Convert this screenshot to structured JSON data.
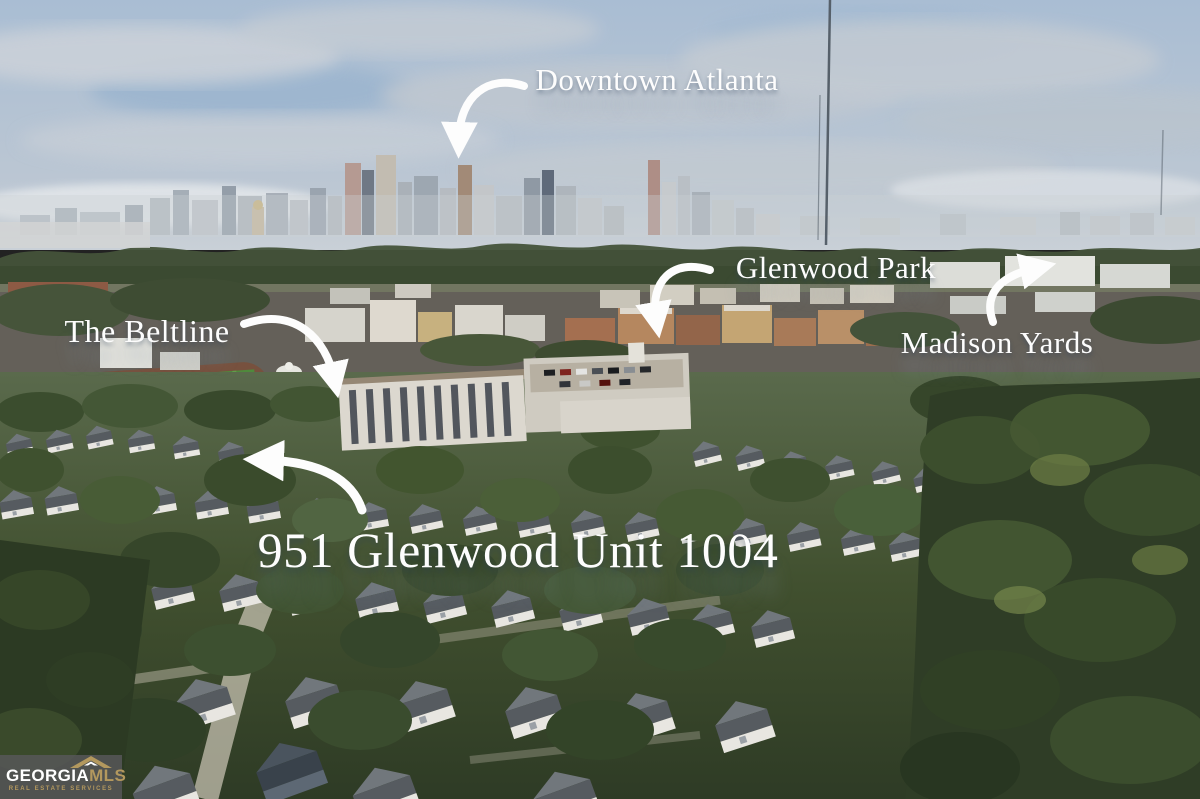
{
  "annotations": {
    "downtown_atlanta": "Downtown Atlanta",
    "glenwood_park": "Glenwood Park",
    "the_beltline": "The Beltline",
    "madison_yards": "Madison Yards",
    "property_title": "951 Glenwood Unit 1004"
  },
  "logo": {
    "brand_primary": "GEORGIA",
    "brand_secondary": "MLS",
    "tagline": "REAL ESTATE SERVICES"
  },
  "colors": {
    "annotation_text": "#fdfdfd",
    "logo_text_primary": "#ffffff",
    "logo_gold": "#b3985e",
    "logo_background": "rgba(88,88,90,0.82)",
    "sky_blue": "#a9bdd3",
    "cloud_gray": "#c2cad3",
    "forest_green": "#35422a",
    "roof_gray": "#565b60",
    "turf_green": "#4f8a3c"
  }
}
